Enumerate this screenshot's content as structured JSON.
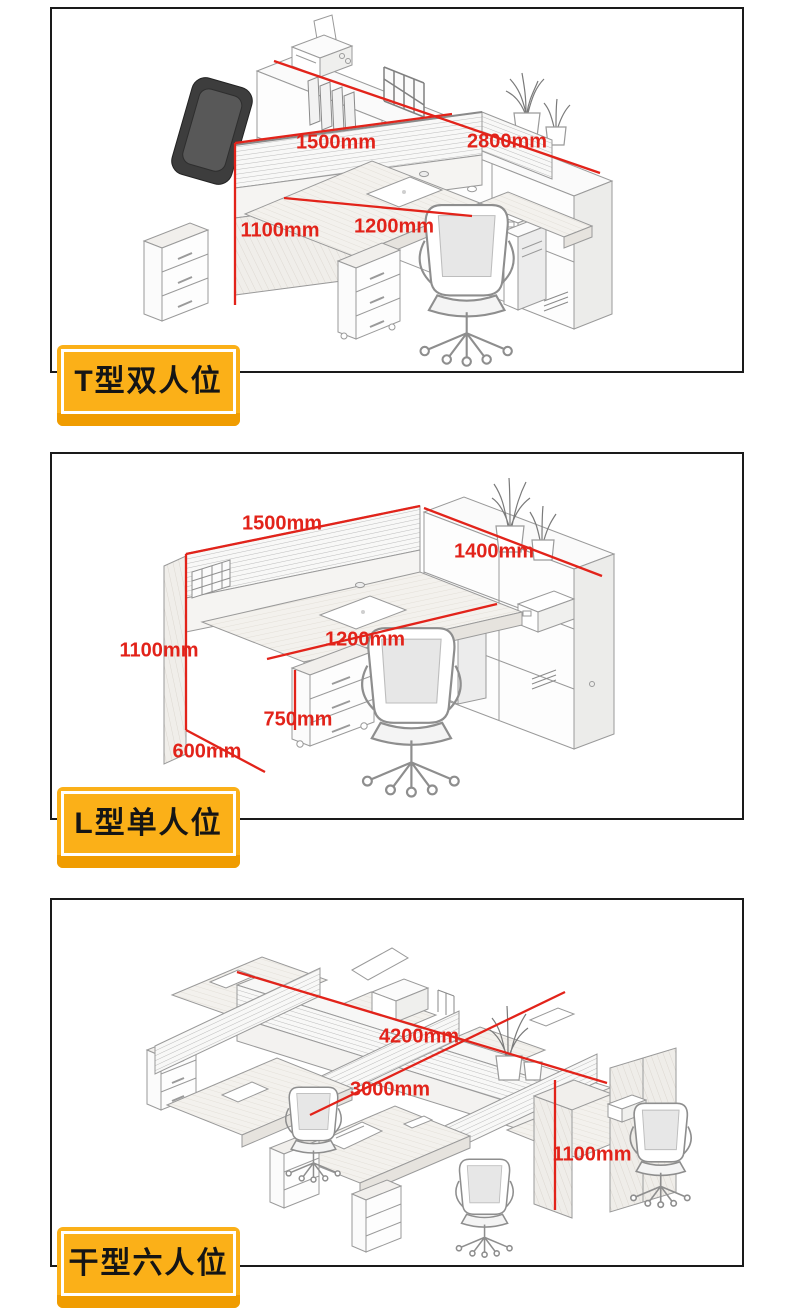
{
  "colors": {
    "dimension_red": "#e2231a",
    "badge_yellow": "#fbb018",
    "badge_yellow_shadow": "#f09c00",
    "panel_border_black": "#1a1a1a",
    "sketch_gray": "#9a9a9a"
  },
  "sections": [
    {
      "name": "t-double",
      "label": "T型双人位",
      "dims": {
        "w1500": "1500mm",
        "w2800": "2800mm",
        "h1100": "1100mm",
        "d1200": "1200mm"
      }
    },
    {
      "name": "l-single",
      "label": "L型单人位",
      "dims": {
        "w1500": "1500mm",
        "w1400": "1400mm",
        "h1100": "1100mm",
        "d1200": "1200mm",
        "h750": "750mm",
        "d600": "600mm"
      }
    },
    {
      "name": "gan-six",
      "label": "干型六人位",
      "dims": {
        "l4200": "4200mm",
        "w3000": "3000mm",
        "h1100": "1100mm"
      }
    }
  ]
}
